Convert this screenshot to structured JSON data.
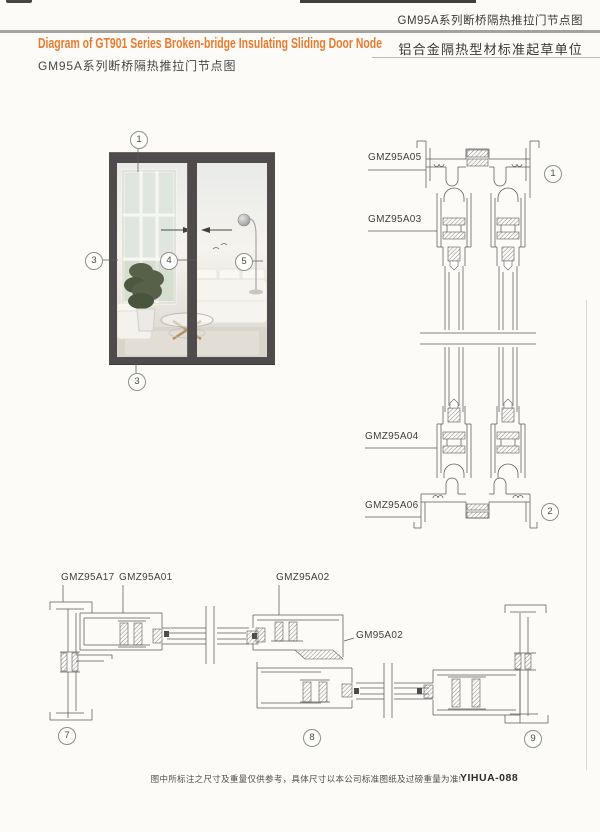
{
  "header": {
    "doc_title_top_right": "GM95A系列断桥隔热推拉门节点图",
    "title_en": "Diagram of GT901 Series Broken-bridge Insulating Sliding Door Node",
    "title_cn": "GM95A系列断桥隔热推拉门节点图",
    "org_label": "铝合金隔热型材标准起草单位"
  },
  "door_figure": {
    "callouts": [
      "1",
      "3",
      "4",
      "5",
      "3"
    ]
  },
  "vertical_section": {
    "labels": [
      "GMZ95A05",
      "GMZ95A03",
      "GMZ95A04",
      "GMZ95A06"
    ],
    "callouts": [
      "1",
      "2"
    ]
  },
  "horizontal_section": {
    "labels": [
      "GMZ95A17",
      "GMZ95A01",
      "GMZ95A02",
      "GM95A02"
    ],
    "callouts": [
      "7",
      "8",
      "9"
    ]
  },
  "footer": {
    "disclaimer": "图中所标注之尺寸及重量仅供参考，具体尺寸以本公司标准图纸及过磅重量为准!",
    "page_code": "YIHUA-088"
  },
  "colors": {
    "accent_orange": "#e87b2e",
    "line_gray": "#5b5c5e",
    "frame_dark": "#4f4b4c"
  }
}
